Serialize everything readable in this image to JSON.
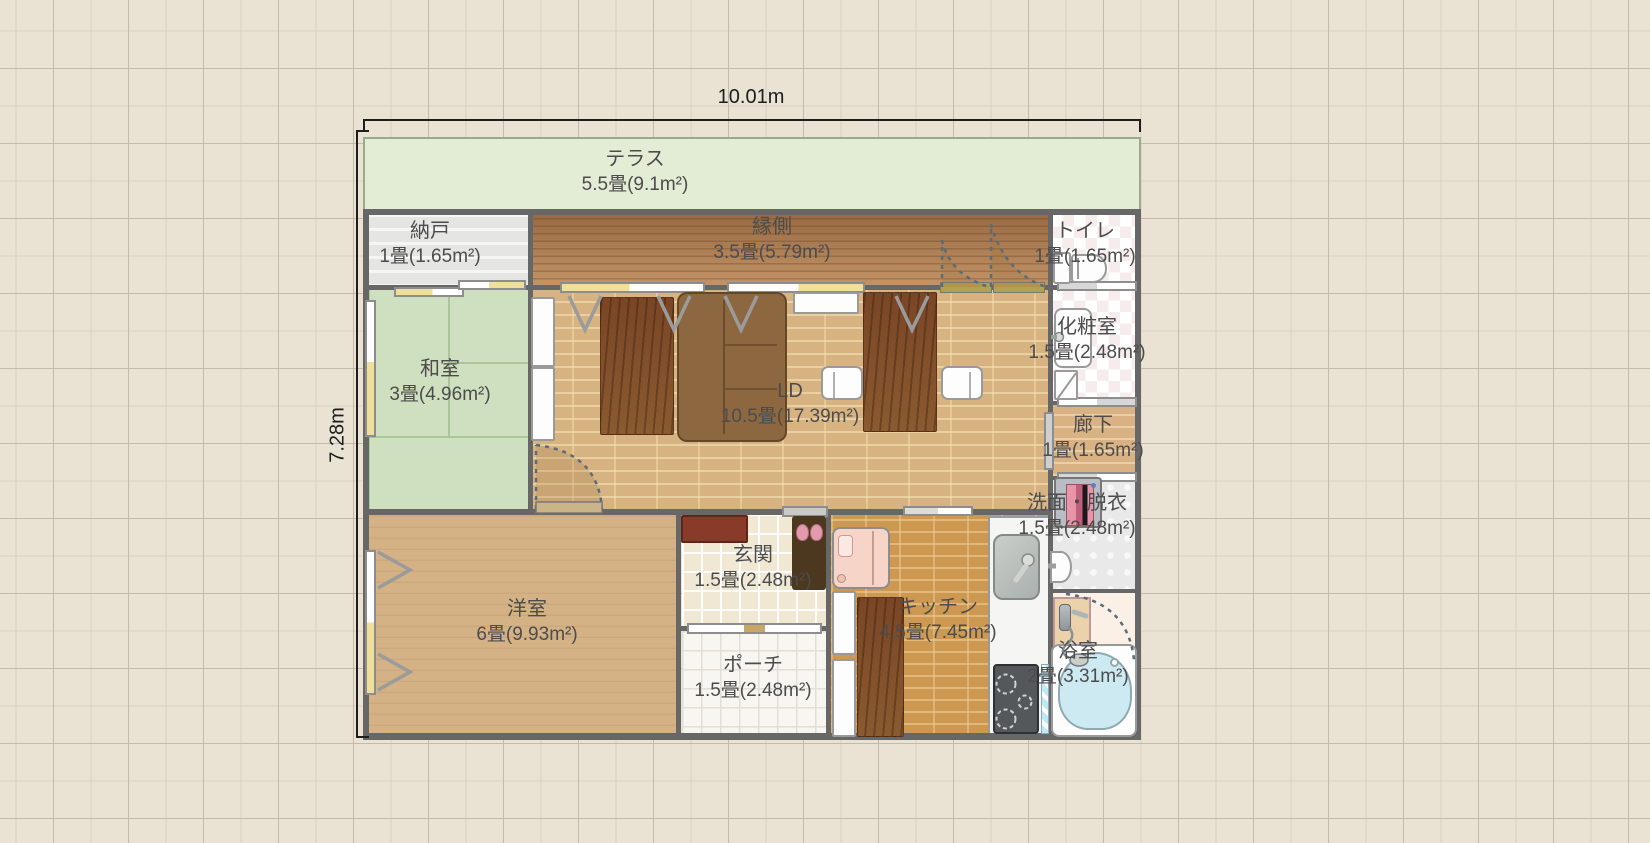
{
  "dimensions": {
    "width_label": "10.01m",
    "height_label": "7.28m"
  },
  "rooms": {
    "terrace": {
      "name": "テラス",
      "area": "5.5畳(9.1m²)"
    },
    "storage": {
      "name": "納戸",
      "area": "1畳(1.65m²)"
    },
    "engawa": {
      "name": "縁側",
      "area": "3.5畳(5.79m²)"
    },
    "toilet": {
      "name": "トイレ",
      "area": "1畳(1.65m²)"
    },
    "washitsu": {
      "name": "和室",
      "area": "3畳(4.96m²)"
    },
    "ld": {
      "name": "LD",
      "area": "10.5畳(17.39m²)"
    },
    "powder": {
      "name": "化粧室",
      "area": "1.5畳(2.48m²)"
    },
    "hallway": {
      "name": "廊下",
      "area": "1畳(1.65m²)"
    },
    "laundry": {
      "name": "洗面・脱衣",
      "area": "1.5畳(2.48m²)"
    },
    "youshitsu": {
      "name": "洋室",
      "area": "6畳(9.93m²)"
    },
    "genkan": {
      "name": "玄関",
      "area": "1.5畳(2.48m²)"
    },
    "kitchen": {
      "name": "キッチン",
      "area": "4.5畳(7.45m²)"
    },
    "porch": {
      "name": "ポーチ",
      "area": "1.5畳(2.48m²)"
    },
    "bath": {
      "name": "浴室",
      "area": "2畳(3.31m²)"
    }
  },
  "colors": {
    "background": "#eae2d3",
    "terrace": "#e3ecd4",
    "tatami": "#cfe0c0",
    "ld_floor": "#d8b382",
    "kitchen_floor": "#cd9851",
    "engawa_floor": "#a87a50",
    "wall": "#676767",
    "label_text": "#4c4c4c",
    "dimension_text": "#1d1d1d",
    "bathtub": "#cde9f2",
    "bed": "#f6d5c8",
    "shoe_cabinet": "#8a3a29"
  }
}
